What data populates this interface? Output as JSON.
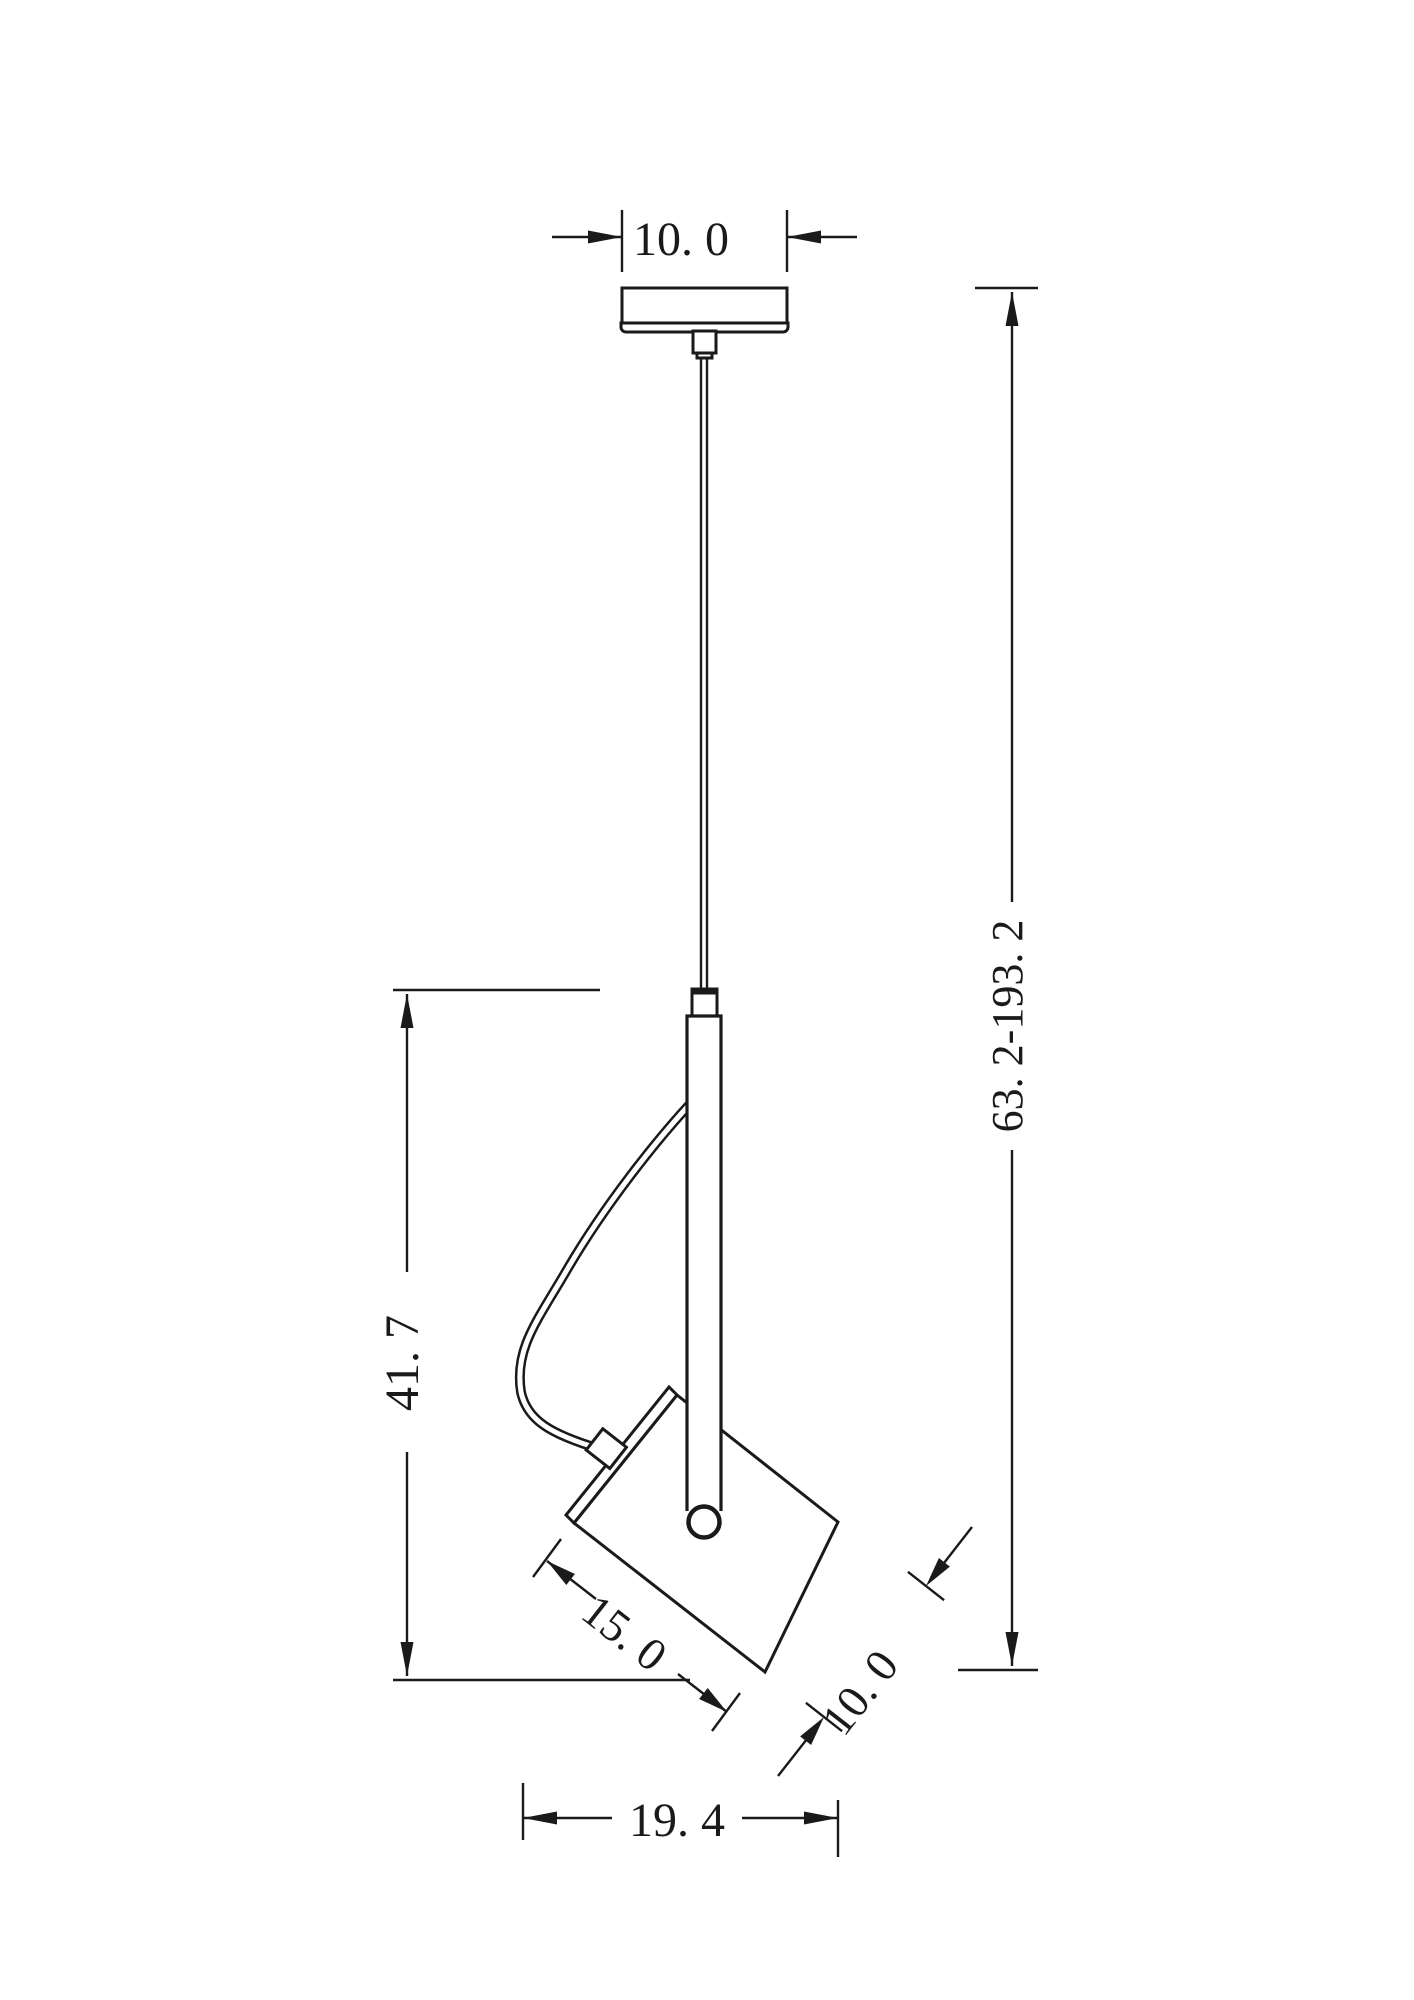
{
  "meta": {
    "title": "Pendant spotlight technical dimension drawing",
    "units": "cm"
  },
  "colors": {
    "background": "#ffffff",
    "line": "#1a1a1a"
  },
  "dimensions": {
    "canopy_width": {
      "label": "10. 0"
    },
    "suspension_height": {
      "label": "63. 2-193. 2"
    },
    "body_height": {
      "label": "41. 7"
    },
    "head_length": {
      "label": "15. 0"
    },
    "head_depth": {
      "label": "10. 0"
    },
    "overall_width": {
      "label": "19. 4"
    }
  }
}
